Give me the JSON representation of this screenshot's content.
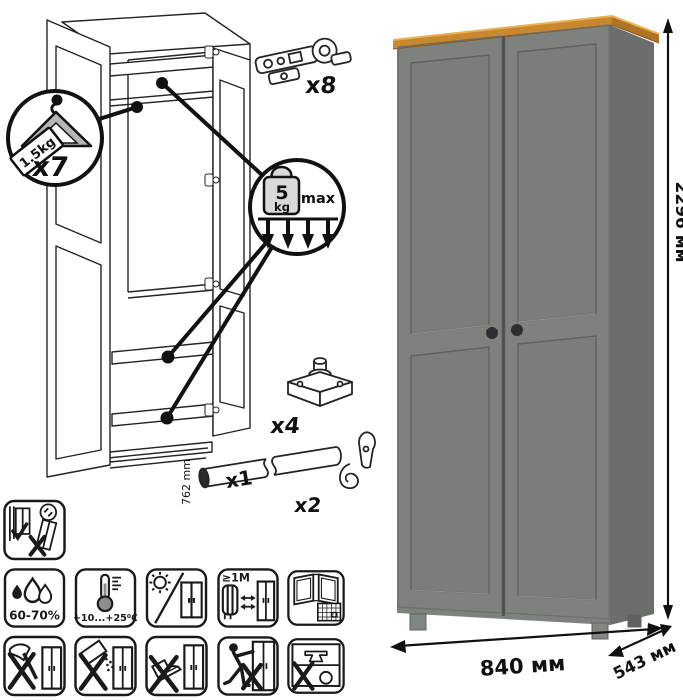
{
  "diagram": {
    "hanger_count": "x7",
    "hanger_capacity": "1.5kg",
    "load_value": "5",
    "load_unit": "kg",
    "load_qualifier": "max",
    "hinge_count": "x8",
    "foot_count": "x4",
    "rod_count": "x1",
    "rod_length": "762 mm",
    "hook_count": "x2"
  },
  "dimensions": {
    "height": "2296 мм",
    "width": "840 мм",
    "depth": "543 мм"
  },
  "care": {
    "humidity": "60-70%",
    "temperature": "+10...+25⁰C",
    "min_distance": "≥1М",
    "calendar_day": "21"
  },
  "colors": {
    "front": "#7e827e",
    "side": "#6b6e6b",
    "panel": "#7a7e7a",
    "wood_top": "#c9872e",
    "wood_side": "#b07425",
    "line": "#1a1a1a",
    "knob": "#2c2e2f"
  }
}
